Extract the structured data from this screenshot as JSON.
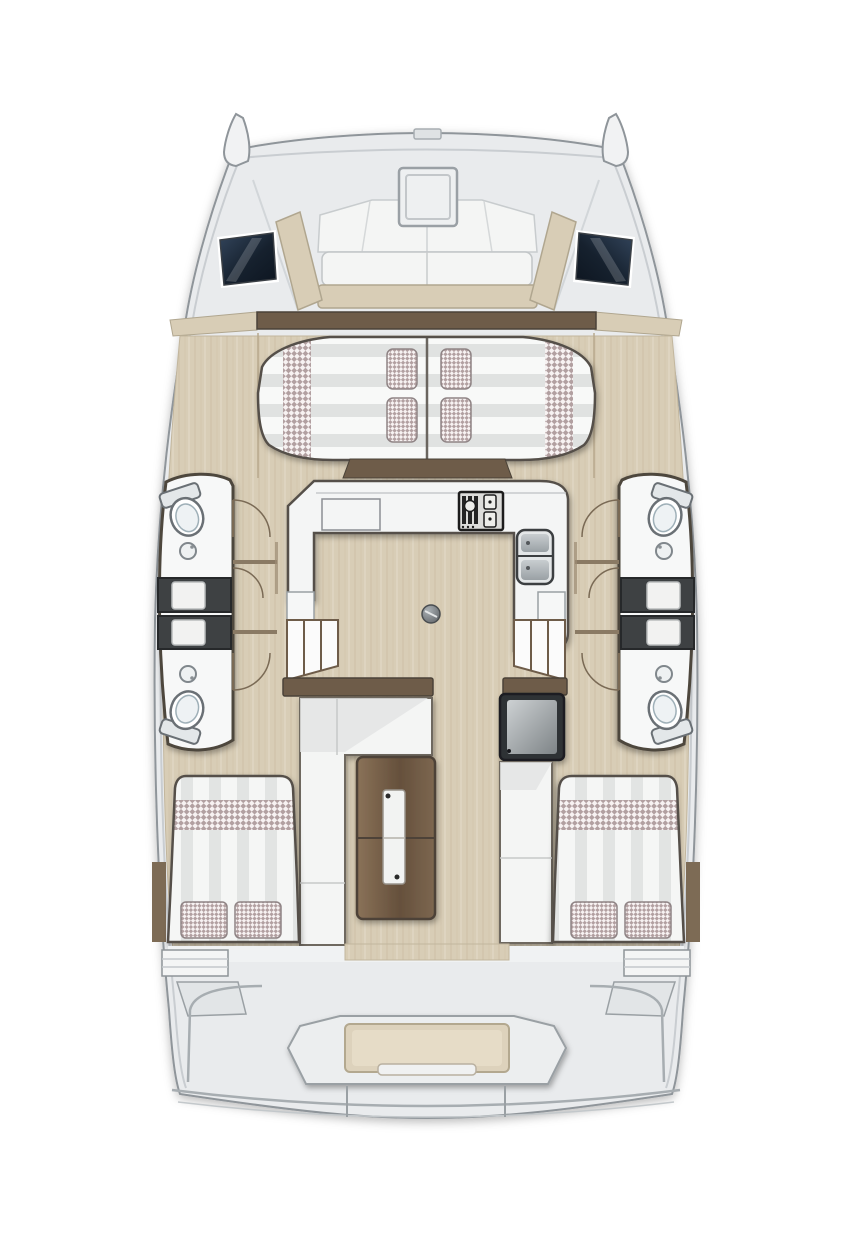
{
  "diagram": {
    "type": "floor-plan",
    "subject": "catamaran-yacht-interior",
    "view": "top-down-bow-up",
    "description": "Top-down interior layout plan of a sailing catamaran: forward cockpit with hatch and windows, forward island berth, central galley saloon with table, four heads with showers in the hulls, two aft cabin berths and aft cockpit bench",
    "features": {
      "bow_tips": 2,
      "foredeck_hatch": 1,
      "forward_cockpit_windows": 2,
      "forward_island_berth_pillows": 4,
      "forward_berth_checkered_bolsters": 2,
      "galley_counter_shape": "U",
      "galley_stove": 1,
      "galley_sink_basins": 2,
      "companionway_steps": 2,
      "heads_compartments": 4,
      "toilets": 4,
      "wash_basins": 4,
      "shower_trays": 4,
      "door_swings": 6,
      "saloon_l_settee": 1,
      "saloon_folding_table": 1,
      "saloon_fridge_unit": 1,
      "saloon_nav_bench": 1,
      "aft_cabin_berths": 2,
      "aft_berth_pillows": 4,
      "aft_cockpit_bench": 1,
      "table_pedestal_mount": 1
    }
  },
  "palette": {
    "background": "#ffffff",
    "hull_deck": "#e9ebed",
    "deck_line": "#8f959a",
    "gunwale_line": "#c9cdd1",
    "seam_line": "#d2d6d9",
    "floor_wood": "#d8cdb6",
    "wood_grain": "#b49e7e",
    "trim_brown": "#6e5c49",
    "trim_dark": "#4a4238",
    "outline_dark": "#55504a",
    "cushion_white": "#f4f5f4",
    "cushion_shade": "#e2e4e3",
    "stripe_grey": "#e0e2e1",
    "check_pink": "#b2a0a1",
    "check_base": "#f7f2f2",
    "shower_dark": "#3e4143",
    "shower_edge": "#26282a",
    "tray_white": "#f2f2f1",
    "window_deep": "#0d1520",
    "window_light": "#33455c",
    "counter_white": "#f4f5f5",
    "steel_grey": "#b6bcc0",
    "fixture_line": "#6a7075",
    "table_wood_light": "#8a7258",
    "table_wood_dark": "#65503c",
    "bench_tan": "#ddd2bc",
    "bench_tan_edge": "#b3a88f"
  }
}
